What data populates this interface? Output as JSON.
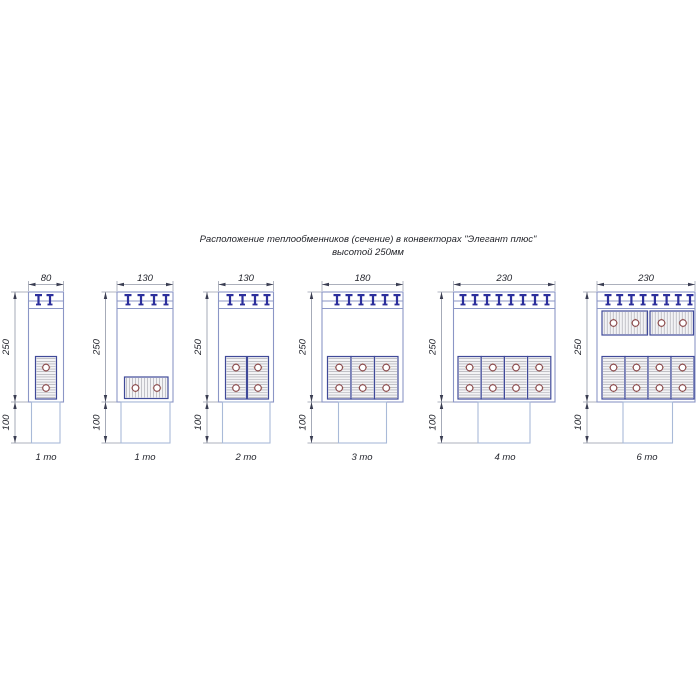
{
  "title": {
    "line1": "Расположение теплообменников (сечение) в конвекторах \"Элегант плюс\"",
    "line2": "высотой 250мм"
  },
  "colors": {
    "outline": "#8b96c6",
    "outline_light": "#a9bad8",
    "marker": "#2c2f9c",
    "dim_line": "#9096a6",
    "arrow": "#3a3d52",
    "block_border": "#404a99",
    "block_fill": "#f3f3f5",
    "hatch": "#a3a3ab",
    "pipe_ring": "#8a4a4e",
    "pipe_cross": "#d2914e"
  },
  "layout": {
    "dim_y": 284.5,
    "width_text_y": 281,
    "body_top": 292,
    "band1_y": 301,
    "band2_y": 308.5,
    "junction_y": 402,
    "ped_bottom_y": 443,
    "label_y": 460
  },
  "diagrams": [
    {
      "label": "1 то",
      "width_label": "80",
      "height_label": "250",
      "base_label": "100",
      "geom": {
        "body_x": 28.5,
        "body_w": 35,
        "ped_x": 31.5,
        "ped_w": 28.5,
        "dim_x": 15,
        "label_cx": 46,
        "markers": [
          38.5,
          50
        ],
        "blocks": [
          {
            "x": 35.5,
            "y": 356.5,
            "w": 21,
            "h": 42.5,
            "hatch": "h",
            "circles": [
              [
                46,
                367.5
              ],
              [
                46,
                388
              ]
            ]
          }
        ]
      }
    },
    {
      "label": "1 то",
      "width_label": "130",
      "height_label": "250",
      "base_label": "100",
      "geom": {
        "body_x": 117,
        "body_w": 56,
        "ped_x": 121,
        "ped_w": 49,
        "dim_x": 105.5,
        "label_cx": 145,
        "markers": [
          128,
          141,
          154,
          166
        ],
        "blocks": [
          {
            "x": 124.5,
            "y": 377,
            "w": 43.5,
            "h": 21.5,
            "hatch": "v",
            "circles": [
              [
                135.5,
                388
              ],
              [
                157,
                388
              ]
            ]
          }
        ]
      }
    },
    {
      "label": "2 то",
      "width_label": "130",
      "height_label": "250",
      "base_label": "100",
      "geom": {
        "body_x": 218.5,
        "body_w": 55,
        "ped_x": 222.5,
        "ped_w": 47.5,
        "dim_x": 207,
        "label_cx": 246,
        "markers": [
          230,
          242.5,
          255,
          267
        ],
        "blocks": [
          {
            "x": 225.5,
            "y": 356.5,
            "w": 21,
            "h": 42.5,
            "hatch": "h",
            "circles": [
              [
                236,
                367.5
              ],
              [
                236,
                388
              ]
            ]
          },
          {
            "x": 247.5,
            "y": 356.5,
            "w": 21,
            "h": 42.5,
            "hatch": "h",
            "circles": [
              [
                258,
                367.5
              ],
              [
                258,
                388
              ]
            ]
          }
        ]
      }
    },
    {
      "label": "3 то",
      "width_label": "180",
      "height_label": "250",
      "base_label": "100",
      "geom": {
        "body_x": 322,
        "body_w": 81,
        "ped_x": 338.5,
        "ped_w": 48,
        "dim_x": 311.5,
        "label_cx": 362,
        "markers": [
          337,
          349,
          361,
          373,
          385,
          397
        ],
        "blocks": [
          {
            "x": 327.5,
            "y": 356.5,
            "w": 23.5,
            "h": 42.5,
            "hatch": "h",
            "circles": [
              [
                339.2,
                367.5
              ],
              [
                339.2,
                388
              ]
            ]
          },
          {
            "x": 351,
            "y": 356.5,
            "w": 23.5,
            "h": 42.5,
            "hatch": "h",
            "circles": [
              [
                362.7,
                367.5
              ],
              [
                362.7,
                388
              ]
            ]
          },
          {
            "x": 374.5,
            "y": 356.5,
            "w": 23.5,
            "h": 42.5,
            "hatch": "h",
            "circles": [
              [
                386.2,
                367.5
              ],
              [
                386.2,
                388
              ]
            ]
          }
        ]
      }
    },
    {
      "label": "4 то",
      "width_label": "230",
      "height_label": "250",
      "base_label": "100",
      "geom": {
        "body_x": 453.5,
        "body_w": 101.5,
        "ped_x": 478,
        "ped_w": 52,
        "dim_x": 441.5,
        "label_cx": 505,
        "markers": [
          463,
          475,
          487,
          499,
          511,
          523,
          535,
          547
        ],
        "blocks": [
          {
            "x": 458,
            "y": 356.5,
            "w": 23.2,
            "h": 42.5,
            "hatch": "h",
            "circles": [
              [
                469.6,
                367.5
              ],
              [
                469.6,
                388
              ]
            ]
          },
          {
            "x": 481.2,
            "y": 356.5,
            "w": 23.2,
            "h": 42.5,
            "hatch": "h",
            "circles": [
              [
                492.8,
                367.5
              ],
              [
                492.8,
                388
              ]
            ]
          },
          {
            "x": 504.4,
            "y": 356.5,
            "w": 23.2,
            "h": 42.5,
            "hatch": "h",
            "circles": [
              [
                516,
                367.5
              ],
              [
                516,
                388
              ]
            ]
          },
          {
            "x": 527.6,
            "y": 356.5,
            "w": 23.2,
            "h": 42.5,
            "hatch": "h",
            "circles": [
              [
                539.2,
                367.5
              ],
              [
                539.2,
                388
              ]
            ]
          }
        ]
      }
    },
    {
      "label": "6 то",
      "width_label": "230",
      "height_label": "250",
      "base_label": "100",
      "geom": {
        "body_x": 597,
        "body_w": 98,
        "ped_x": 623,
        "ped_w": 49.5,
        "dim_x": 587,
        "label_cx": 647,
        "markers": [
          608,
          619.7,
          631.4,
          643.1,
          654.9,
          666.6,
          678.3,
          690
        ],
        "blocks": [
          {
            "x": 602,
            "y": 311,
            "w": 45.5,
            "h": 24,
            "hatch": "v",
            "circles": [
              [
                613.5,
                323
              ],
              [
                635.5,
                323
              ]
            ]
          },
          {
            "x": 650,
            "y": 311,
            "w": 43.5,
            "h": 24,
            "hatch": "v",
            "circles": [
              [
                661.5,
                323
              ],
              [
                683,
                323
              ]
            ]
          },
          {
            "x": 602,
            "y": 356.5,
            "w": 23,
            "h": 42.5,
            "hatch": "h",
            "circles": [
              [
                613.5,
                367.5
              ],
              [
                613.5,
                388
              ]
            ]
          },
          {
            "x": 625,
            "y": 356.5,
            "w": 23,
            "h": 42.5,
            "hatch": "h",
            "circles": [
              [
                636.5,
                367.5
              ],
              [
                636.5,
                388
              ]
            ]
          },
          {
            "x": 648,
            "y": 356.5,
            "w": 23,
            "h": 42.5,
            "hatch": "h",
            "circles": [
              [
                659.5,
                367.5
              ],
              [
                659.5,
                388
              ]
            ]
          },
          {
            "x": 671,
            "y": 356.5,
            "w": 23,
            "h": 42.5,
            "hatch": "h",
            "circles": [
              [
                682.5,
                367.5
              ],
              [
                682.5,
                388
              ]
            ]
          }
        ]
      }
    }
  ]
}
